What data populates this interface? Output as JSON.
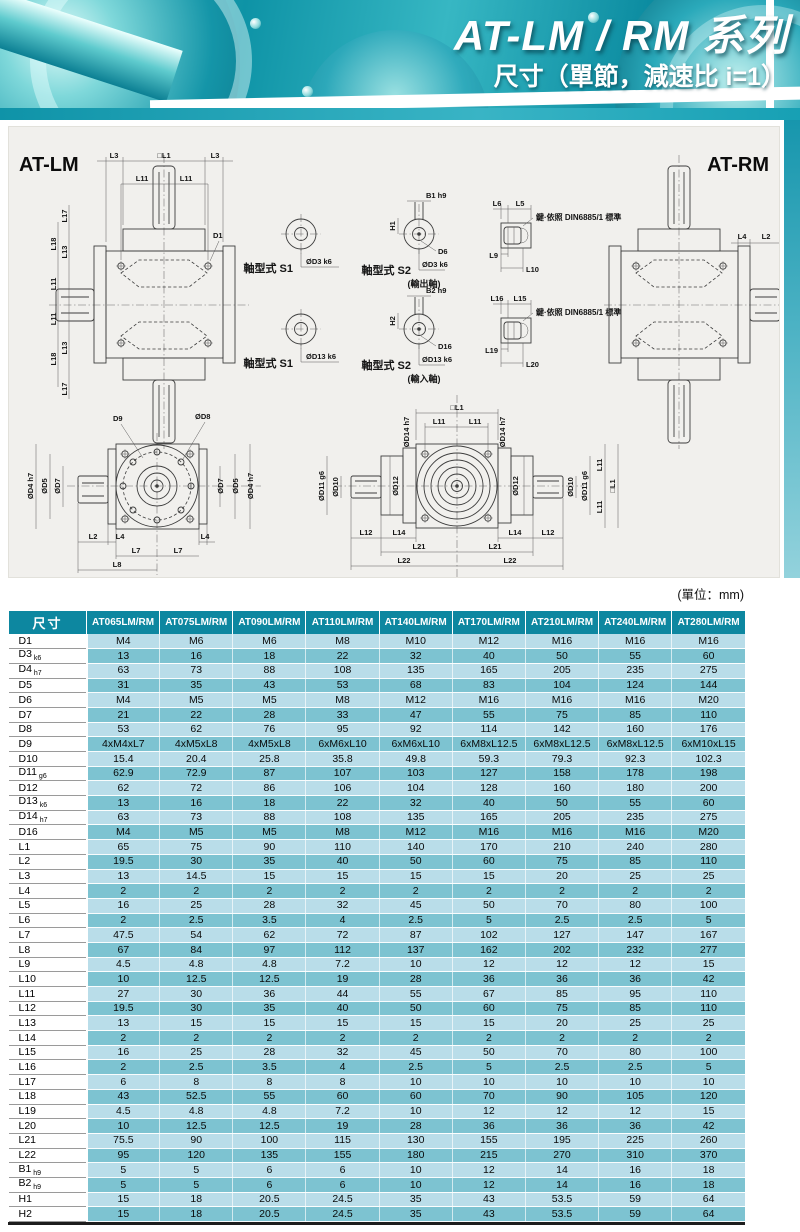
{
  "header": {
    "title": "AT-LM / RM 系列",
    "subtitle": "尺寸（單節，減速比 i=1）"
  },
  "diagram": {
    "lm_title": "AT-LM",
    "rm_title": "AT-RM",
    "unit_note": "(單位：mm)",
    "shaft_type_s1": "軸型式 S1",
    "shaft_type_s2": "軸型式 S2",
    "output_shaft": "(輸出軸)",
    "input_shaft": "(輸入軸)",
    "key_note": "鍵·依照 DIN6885/1 標準",
    "dims": {
      "L1": "□L1",
      "L2": "L2",
      "L3": "L3",
      "L4": "L4",
      "L5": "L5",
      "L6": "L6",
      "L7": "L7",
      "L8": "L8",
      "L9": "L9",
      "L10": "L10",
      "L11": "L11",
      "L12": "L12",
      "L13": "L13",
      "L14": "L14",
      "L15": "L15",
      "L16": "L16",
      "L17": "L17",
      "L18": "L18",
      "L19": "L19",
      "L20": "L20",
      "L21": "L21",
      "L22": "L22",
      "D1": "D1",
      "D6": "D6",
      "D9": "D9",
      "D16": "D16",
      "D3": "ØD3 k6",
      "D13": "ØD13 k6",
      "D4": "ØD4 h7",
      "D5": "ØD5",
      "D7": "ØD7",
      "D8": "ØD8",
      "D10": "ØD10",
      "D11": "ØD11 g6",
      "D12": "ØD12",
      "D14": "ØD14 h7",
      "B1": "B1 h9",
      "B2": "B2 h9",
      "H1": "H1",
      "H2": "H2"
    }
  },
  "table": {
    "corner_label": "尺寸",
    "columns": [
      "AT065LM/RM",
      "AT075LM/RM",
      "AT090LM/RM",
      "AT110LM/RM",
      "AT140LM/RM",
      "AT170LM/RM",
      "AT210LM/RM",
      "AT240LM/RM",
      "AT280LM/RM"
    ],
    "rows": [
      {
        "label": "D1",
        "sub": "",
        "values": [
          "M4",
          "M6",
          "M6",
          "M8",
          "M10",
          "M12",
          "M16",
          "M16",
          "M16"
        ]
      },
      {
        "label": "D3",
        "sub": "k6",
        "values": [
          "13",
          "16",
          "18",
          "22",
          "32",
          "40",
          "50",
          "55",
          "60"
        ]
      },
      {
        "label": "D4",
        "sub": "h7",
        "values": [
          "63",
          "73",
          "88",
          "108",
          "135",
          "165",
          "205",
          "235",
          "275"
        ]
      },
      {
        "label": "D5",
        "sub": "",
        "values": [
          "31",
          "35",
          "43",
          "53",
          "68",
          "83",
          "104",
          "124",
          "144"
        ]
      },
      {
        "label": "D6",
        "sub": "",
        "values": [
          "M4",
          "M5",
          "M5",
          "M8",
          "M12",
          "M16",
          "M16",
          "M16",
          "M20"
        ]
      },
      {
        "label": "D7",
        "sub": "",
        "values": [
          "21",
          "22",
          "28",
          "33",
          "47",
          "55",
          "75",
          "85",
          "110"
        ]
      },
      {
        "label": "D8",
        "sub": "",
        "values": [
          "53",
          "62",
          "76",
          "95",
          "92",
          "114",
          "142",
          "160",
          "176"
        ]
      },
      {
        "label": "D9",
        "sub": "",
        "values": [
          "4xM4xL7",
          "4xM5xL8",
          "4xM5xL8",
          "6xM6xL10",
          "6xM6xL10",
          "6xM8xL12.5",
          "6xM8xL12.5",
          "6xM8xL12.5",
          "6xM10xL15"
        ]
      },
      {
        "label": "D10",
        "sub": "",
        "values": [
          "15.4",
          "20.4",
          "25.8",
          "35.8",
          "49.8",
          "59.3",
          "79.3",
          "92.3",
          "102.3"
        ]
      },
      {
        "label": "D11",
        "sub": "g6",
        "values": [
          "62.9",
          "72.9",
          "87",
          "107",
          "103",
          "127",
          "158",
          "178",
          "198"
        ]
      },
      {
        "label": "D12",
        "sub": "",
        "values": [
          "62",
          "72",
          "86",
          "106",
          "104",
          "128",
          "160",
          "180",
          "200"
        ]
      },
      {
        "label": "D13",
        "sub": "k6",
        "values": [
          "13",
          "16",
          "18",
          "22",
          "32",
          "40",
          "50",
          "55",
          "60"
        ]
      },
      {
        "label": "D14",
        "sub": "h7",
        "values": [
          "63",
          "73",
          "88",
          "108",
          "135",
          "165",
          "205",
          "235",
          "275"
        ]
      },
      {
        "label": "D16",
        "sub": "",
        "values": [
          "M4",
          "M5",
          "M5",
          "M8",
          "M12",
          "M16",
          "M16",
          "M16",
          "M20"
        ]
      },
      {
        "label": "L1",
        "sub": "",
        "values": [
          "65",
          "75",
          "90",
          "110",
          "140",
          "170",
          "210",
          "240",
          "280"
        ]
      },
      {
        "label": "L2",
        "sub": "",
        "values": [
          "19.5",
          "30",
          "35",
          "40",
          "50",
          "60",
          "75",
          "85",
          "110"
        ]
      },
      {
        "label": "L3",
        "sub": "",
        "values": [
          "13",
          "14.5",
          "15",
          "15",
          "15",
          "15",
          "20",
          "25",
          "25"
        ]
      },
      {
        "label": "L4",
        "sub": "",
        "values": [
          "2",
          "2",
          "2",
          "2",
          "2",
          "2",
          "2",
          "2",
          "2"
        ]
      },
      {
        "label": "L5",
        "sub": "",
        "values": [
          "16",
          "25",
          "28",
          "32",
          "45",
          "50",
          "70",
          "80",
          "100"
        ]
      },
      {
        "label": "L6",
        "sub": "",
        "values": [
          "2",
          "2.5",
          "3.5",
          "4",
          "2.5",
          "5",
          "2.5",
          "2.5",
          "5"
        ]
      },
      {
        "label": "L7",
        "sub": "",
        "values": [
          "47.5",
          "54",
          "62",
          "72",
          "87",
          "102",
          "127",
          "147",
          "167"
        ]
      },
      {
        "label": "L8",
        "sub": "",
        "values": [
          "67",
          "84",
          "97",
          "112",
          "137",
          "162",
          "202",
          "232",
          "277"
        ]
      },
      {
        "label": "L9",
        "sub": "",
        "values": [
          "4.5",
          "4.8",
          "4.8",
          "7.2",
          "10",
          "12",
          "12",
          "12",
          "15"
        ]
      },
      {
        "label": "L10",
        "sub": "",
        "values": [
          "10",
          "12.5",
          "12.5",
          "19",
          "28",
          "36",
          "36",
          "36",
          "42"
        ]
      },
      {
        "label": "L11",
        "sub": "",
        "values": [
          "27",
          "30",
          "36",
          "44",
          "55",
          "67",
          "85",
          "95",
          "110"
        ]
      },
      {
        "label": "L12",
        "sub": "",
        "values": [
          "19.5",
          "30",
          "35",
          "40",
          "50",
          "60",
          "75",
          "85",
          "110"
        ]
      },
      {
        "label": "L13",
        "sub": "",
        "values": [
          "13",
          "15",
          "15",
          "15",
          "15",
          "15",
          "20",
          "25",
          "25"
        ]
      },
      {
        "label": "L14",
        "sub": "",
        "values": [
          "2",
          "2",
          "2",
          "2",
          "2",
          "2",
          "2",
          "2",
          "2"
        ]
      },
      {
        "label": "L15",
        "sub": "",
        "values": [
          "16",
          "25",
          "28",
          "32",
          "45",
          "50",
          "70",
          "80",
          "100"
        ]
      },
      {
        "label": "L16",
        "sub": "",
        "values": [
          "2",
          "2.5",
          "3.5",
          "4",
          "2.5",
          "5",
          "2.5",
          "2.5",
          "5"
        ]
      },
      {
        "label": "L17",
        "sub": "",
        "values": [
          "6",
          "8",
          "8",
          "8",
          "10",
          "10",
          "10",
          "10",
          "10"
        ]
      },
      {
        "label": "L18",
        "sub": "",
        "values": [
          "43",
          "52.5",
          "55",
          "60",
          "60",
          "70",
          "90",
          "105",
          "120"
        ]
      },
      {
        "label": "L19",
        "sub": "",
        "values": [
          "4.5",
          "4.8",
          "4.8",
          "7.2",
          "10",
          "12",
          "12",
          "12",
          "15"
        ]
      },
      {
        "label": "L20",
        "sub": "",
        "values": [
          "10",
          "12.5",
          "12.5",
          "19",
          "28",
          "36",
          "36",
          "36",
          "42"
        ]
      },
      {
        "label": "L21",
        "sub": "",
        "values": [
          "75.5",
          "90",
          "100",
          "115",
          "130",
          "155",
          "195",
          "225",
          "260"
        ]
      },
      {
        "label": "L22",
        "sub": "",
        "values": [
          "95",
          "120",
          "135",
          "155",
          "180",
          "215",
          "270",
          "310",
          "370"
        ]
      },
      {
        "label": "B1",
        "sub": "h9",
        "values": [
          "5",
          "5",
          "6",
          "6",
          "10",
          "12",
          "14",
          "16",
          "18"
        ]
      },
      {
        "label": "B2",
        "sub": "h9",
        "values": [
          "5",
          "5",
          "6",
          "6",
          "10",
          "12",
          "14",
          "16",
          "18"
        ]
      },
      {
        "label": "H1",
        "sub": "",
        "values": [
          "15",
          "18",
          "20.5",
          "24.5",
          "35",
          "43",
          "53.5",
          "59",
          "64"
        ]
      },
      {
        "label": "H2",
        "sub": "",
        "values": [
          "15",
          "18",
          "20.5",
          "24.5",
          "35",
          "43",
          "53.5",
          "59",
          "64"
        ]
      }
    ]
  }
}
